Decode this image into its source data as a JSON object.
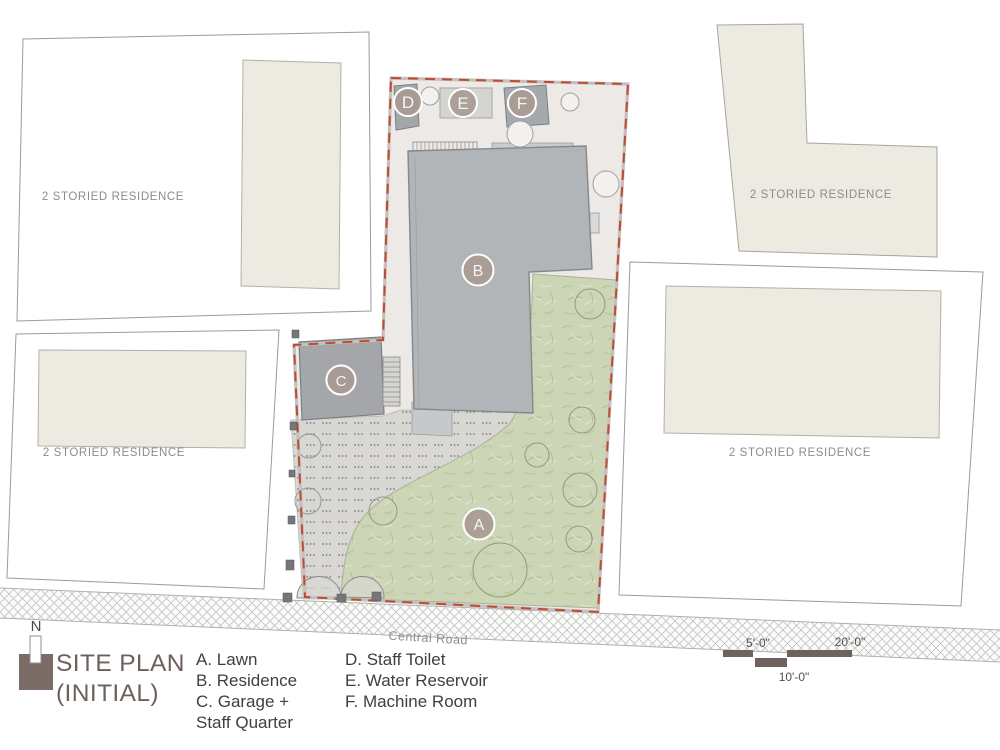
{
  "drawing": {
    "title_line1": "SITE PLAN",
    "title_line2": "(INITIAL)",
    "north": "N",
    "road": "Central Road",
    "neighbor_label": "2 STORIED RESIDENCE",
    "zone_labels": {
      "A": "A",
      "B": "B",
      "C": "C",
      "D": "D",
      "E": "E",
      "F": "F"
    },
    "legend": {
      "col1": [
        "A. Lawn",
        "B. Residence",
        "C. Garage +",
        "Staff Quarter"
      ],
      "col2": [
        "D. Staff Toilet",
        "E. Water Reservoir",
        "F. Machine Room"
      ]
    },
    "scale": {
      "five": "5'-0\"",
      "twenty": "20'-0\"",
      "ten": "10'-0\""
    },
    "colors": {
      "boundary_red": "#bf4b32",
      "site_bg": "#ece9e7",
      "building_gray": "#b2b5b8",
      "outbuilding_gray": "#a4a6a9",
      "lawn_green": "#ccd6b6",
      "driveway_gray": "#d8d7d4",
      "footprint_beige": "#edeae1",
      "ink_dark": "#6f625e"
    }
  }
}
